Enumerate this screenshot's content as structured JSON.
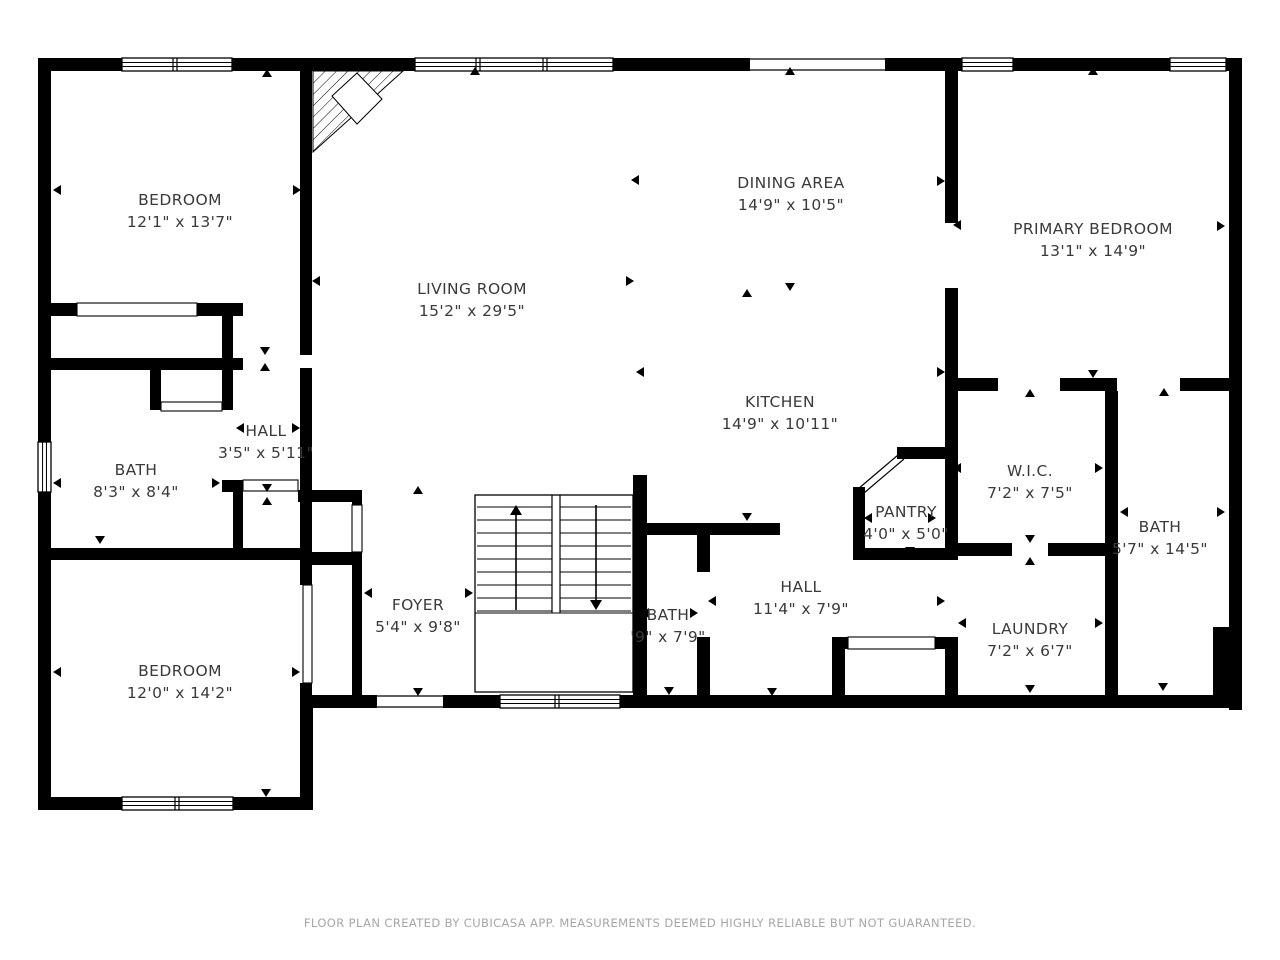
{
  "footer": {
    "text": "FLOOR PLAN CREATED BY CUBICASA APP. MEASUREMENTS DEEMED HIGHLY RELIABLE BUT NOT GUARANTEED."
  },
  "colors": {
    "wall": "#000000",
    "label": "#3a3a3a",
    "footer": "#a6a6a6",
    "background": "#ffffff"
  },
  "rooms": [
    {
      "id": "bedroom-top-left",
      "name": "BEDROOM",
      "dims": "12'1\" x 13'7\"",
      "cx": 180,
      "cy": 200
    },
    {
      "id": "living-room",
      "name": "LIVING ROOM",
      "dims": "15'2\" x 29'5\"",
      "cx": 472,
      "cy": 289
    },
    {
      "id": "dining-area",
      "name": "DINING AREA",
      "dims": "14'9\" x 10'5\"",
      "cx": 791,
      "cy": 183
    },
    {
      "id": "primary-bedroom",
      "name": "PRIMARY BEDROOM",
      "dims": "13'1\" x 14'9\"",
      "cx": 1093,
      "cy": 229
    },
    {
      "id": "hall-small",
      "name": "HALL",
      "dims": "3'5\" x 5'11\"",
      "cx": 266,
      "cy": 431
    },
    {
      "id": "bath-left",
      "name": "BATH",
      "dims": "8'3\" x 8'4\"",
      "cx": 136,
      "cy": 470
    },
    {
      "id": "kitchen",
      "name": "KITCHEN",
      "dims": "14'9\" x 10'11\"",
      "cx": 780,
      "cy": 402
    },
    {
      "id": "wic",
      "name": "W.I.C.",
      "dims": "7'2\" x 7'5\"",
      "cx": 1030,
      "cy": 471
    },
    {
      "id": "pantry",
      "name": "PANTRY",
      "dims": "4'0\" x 5'0\"",
      "cx": 906,
      "cy": 512
    },
    {
      "id": "bath-right",
      "name": "BATH",
      "dims": "5'7\" x 14'5\"",
      "cx": 1160,
      "cy": 527
    },
    {
      "id": "foyer",
      "name": "FOYER",
      "dims": "5'4\" x 9'8\"",
      "cx": 418,
      "cy": 605
    },
    {
      "id": "bath-middle",
      "name": "BATH",
      "dims": "'9\" x 7'9\"",
      "cx": 668,
      "cy": 615
    },
    {
      "id": "hall-big",
      "name": "HALL",
      "dims": "11'4\" x 7'9\"",
      "cx": 801,
      "cy": 587
    },
    {
      "id": "laundry",
      "name": "LAUNDRY",
      "dims": "7'2\" x 6'7\"",
      "cx": 1030,
      "cy": 629
    },
    {
      "id": "bedroom-bottom-left",
      "name": "BEDROOM",
      "dims": "12'0\" x 14'2\"",
      "cx": 180,
      "cy": 671
    }
  ],
  "walls": [
    [
      38,
      58,
      84,
      13
    ],
    [
      232,
      58,
      183,
      13
    ],
    [
      613,
      58,
      137,
      13
    ],
    [
      885,
      58,
      77,
      13
    ],
    [
      1013,
      58,
      157,
      13
    ],
    [
      1226,
      58,
      16,
      13
    ],
    [
      38,
      58,
      13,
      384
    ],
    [
      38,
      492,
      13,
      318
    ],
    [
      1229,
      58,
      13,
      652
    ],
    [
      300,
      695,
      77,
      13
    ],
    [
      443,
      695,
      57,
      13
    ],
    [
      620,
      695,
      622,
      13
    ],
    [
      38,
      797,
      84,
      13
    ],
    [
      233,
      797,
      80,
      13
    ],
    [
      300,
      695,
      13,
      115
    ],
    [
      38,
      303,
      39,
      13
    ],
    [
      197,
      303,
      46,
      13
    ],
    [
      222,
      303,
      11,
      107
    ],
    [
      38,
      358,
      205,
      12
    ],
    [
      222,
      480,
      11,
      12
    ],
    [
      150,
      365,
      11,
      45
    ],
    [
      38,
      548,
      265,
      12
    ],
    [
      233,
      480,
      10,
      68
    ],
    [
      300,
      58,
      12,
      297
    ],
    [
      300,
      368,
      12,
      217
    ],
    [
      300,
      683,
      12,
      25
    ],
    [
      298,
      490,
      64,
      12
    ],
    [
      352,
      490,
      10,
      15
    ],
    [
      352,
      552,
      10,
      145
    ],
    [
      303,
      552,
      49,
      13
    ],
    [
      633,
      475,
      14,
      233
    ],
    [
      642,
      523,
      138,
      12
    ],
    [
      697,
      523,
      13,
      49
    ],
    [
      697,
      637,
      13,
      71
    ],
    [
      853,
      487,
      12,
      73
    ],
    [
      897,
      447,
      61,
      12
    ],
    [
      853,
      548,
      105,
      12
    ],
    [
      945,
      58,
      13,
      165
    ],
    [
      945,
      288,
      13,
      272
    ],
    [
      945,
      637,
      13,
      71
    ],
    [
      945,
      378,
      53,
      13
    ],
    [
      1060,
      378,
      57,
      13
    ],
    [
      1180,
      378,
      62,
      13
    ],
    [
      1105,
      391,
      13,
      152
    ],
    [
      1105,
      556,
      13,
      152
    ],
    [
      945,
      543,
      67,
      13
    ],
    [
      1048,
      543,
      70,
      13
    ],
    [
      832,
      637,
      13,
      58
    ],
    [
      832,
      637,
      16,
      12
    ],
    [
      935,
      637,
      23,
      12
    ],
    [
      1213,
      627,
      29,
      81
    ]
  ],
  "windows": [
    {
      "x": 122,
      "y": 58,
      "w": 110,
      "h": 13,
      "orient": "h",
      "mullions": [
        175
      ]
    },
    {
      "x": 415,
      "y": 58,
      "w": 198,
      "h": 13,
      "orient": "h",
      "mullions": [
        478,
        545
      ]
    },
    {
      "x": 962,
      "y": 58,
      "w": 51,
      "h": 13,
      "orient": "h",
      "mullions": []
    },
    {
      "x": 1170,
      "y": 58,
      "w": 56,
      "h": 13,
      "orient": "h",
      "mullions": []
    },
    {
      "x": 38,
      "y": 442,
      "w": 13,
      "h": 50,
      "orient": "v",
      "mullions": []
    },
    {
      "x": 122,
      "y": 797,
      "w": 111,
      "h": 13,
      "orient": "h",
      "mullions": [
        177
      ]
    },
    {
      "x": 500,
      "y": 695,
      "w": 120,
      "h": 13,
      "orient": "h",
      "mullions": [
        557
      ]
    }
  ],
  "thin_doors": [
    {
      "x": 77,
      "y": 303,
      "w": 120,
      "h": 13,
      "orient": "h"
    },
    {
      "x": 161,
      "y": 402,
      "w": 61,
      "h": 9,
      "orient": "h"
    },
    {
      "x": 243,
      "y": 480,
      "w": 55,
      "h": 11,
      "orient": "h"
    },
    {
      "x": 352,
      "y": 505,
      "w": 10,
      "h": 47,
      "orient": "v"
    },
    {
      "x": 303,
      "y": 585,
      "w": 9,
      "h": 98,
      "orient": "v"
    },
    {
      "x": 848,
      "y": 637,
      "w": 87,
      "h": 12,
      "orient": "h"
    }
  ],
  "openings": [
    {
      "x": 750,
      "y": 58,
      "w": 135,
      "h": 13
    },
    {
      "x": 377,
      "y": 695,
      "w": 66,
      "h": 13
    }
  ],
  "stairs": {
    "x": 475,
    "y": 495,
    "w": 158,
    "h": 197,
    "divider_x1": 552,
    "divider_x2": 560,
    "divider_y2": 613,
    "treads_y0": 507,
    "treads_dy": 13,
    "treads_n": 9,
    "left_x1": 477,
    "left_x2": 552,
    "right_x1": 560,
    "right_x2": 631,
    "up_arrow": {
      "x": 516,
      "y1": 610,
      "y2": 505
    },
    "down_arrow": {
      "x": 596,
      "y1": 505,
      "y2": 610
    }
  },
  "fireplace": {
    "triangle": [
      [
        313,
        71
      ],
      [
        403,
        71
      ],
      [
        313,
        152
      ]
    ],
    "diamond": [
      [
        332,
        96
      ],
      [
        357,
        73
      ],
      [
        382,
        99
      ],
      [
        357,
        124
      ]
    ]
  },
  "pantry_door": {
    "line1": [
      [
        858,
        489
      ],
      [
        898,
        455
      ]
    ],
    "line2": [
      [
        864,
        493
      ],
      [
        904,
        459
      ]
    ]
  },
  "markers": [
    [
      267,
      73,
      "u"
    ],
    [
      57,
      190,
      "l"
    ],
    [
      297,
      190,
      "r"
    ],
    [
      265,
      351,
      "d"
    ],
    [
      265,
      367,
      "u"
    ],
    [
      475,
      71,
      "u"
    ],
    [
      316,
      281,
      "l"
    ],
    [
      630,
      281,
      "r"
    ],
    [
      635,
      180,
      "l"
    ],
    [
      941,
      181,
      "r"
    ],
    [
      790,
      71,
      "u"
    ],
    [
      790,
      287,
      "d"
    ],
    [
      747,
      293,
      "u"
    ],
    [
      1093,
      71,
      "u"
    ],
    [
      957,
      225,
      "l"
    ],
    [
      1221,
      226,
      "r"
    ],
    [
      1093,
      374,
      "d"
    ],
    [
      100,
      364,
      "u"
    ],
    [
      57,
      483,
      "l"
    ],
    [
      216,
      483,
      "r"
    ],
    [
      100,
      540,
      "d"
    ],
    [
      240,
      428,
      "l"
    ],
    [
      296,
      428,
      "r"
    ],
    [
      267,
      488,
      "d"
    ],
    [
      267,
      501,
      "u"
    ],
    [
      640,
      372,
      "l"
    ],
    [
      941,
      372,
      "r"
    ],
    [
      747,
      517,
      "d"
    ],
    [
      910,
      452,
      "u"
    ],
    [
      868,
      518,
      "l"
    ],
    [
      932,
      518,
      "r"
    ],
    [
      910,
      551,
      "d"
    ],
    [
      1030,
      393,
      "u"
    ],
    [
      957,
      468,
      "l"
    ],
    [
      1099,
      468,
      "r"
    ],
    [
      1030,
      539,
      "d"
    ],
    [
      1030,
      561,
      "u"
    ],
    [
      1164,
      392,
      "u"
    ],
    [
      1124,
      512,
      "l"
    ],
    [
      1221,
      512,
      "r"
    ],
    [
      1163,
      687,
      "d"
    ],
    [
      962,
      623,
      "l"
    ],
    [
      1099,
      623,
      "r"
    ],
    [
      1030,
      689,
      "d"
    ],
    [
      941,
      601,
      "r"
    ],
    [
      712,
      601,
      "l"
    ],
    [
      772,
      692,
      "d"
    ],
    [
      645,
      613,
      "l"
    ],
    [
      694,
      613,
      "r"
    ],
    [
      669,
      691,
      "d"
    ],
    [
      418,
      490,
      "u"
    ],
    [
      368,
      593,
      "l"
    ],
    [
      469,
      593,
      "r"
    ],
    [
      418,
      692,
      "d"
    ],
    [
      57,
      672,
      "l"
    ],
    [
      296,
      672,
      "r"
    ],
    [
      266,
      793,
      "d"
    ]
  ]
}
